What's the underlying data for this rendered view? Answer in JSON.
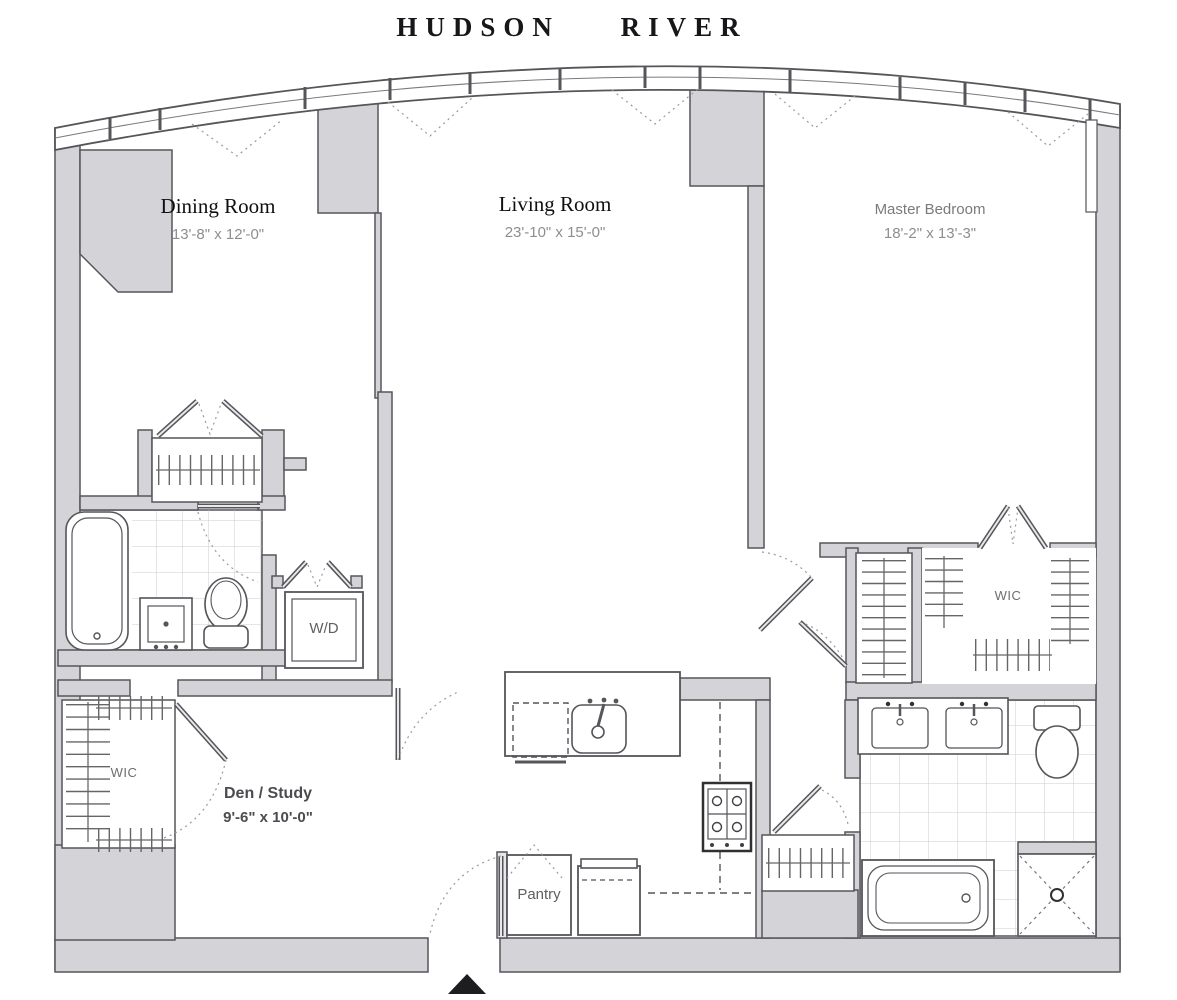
{
  "title": "HUDSON RIVER",
  "rooms": {
    "dining": {
      "name": "Dining Room",
      "dims": "13'-8\" x 12'-0\""
    },
    "living": {
      "name": "Living Room",
      "dims": "23'-10\" x 15'-0\""
    },
    "master": {
      "name": "Master Bedroom",
      "dims": "18'-2\" x 13'-3\""
    },
    "den": {
      "name": "Den / Study",
      "dims": "9'-6\" x 10'-0\""
    }
  },
  "labels": {
    "wic_left": "WIC",
    "wic_right": "WIC",
    "washer_dryer": "W/D",
    "pantry": "Pantry"
  },
  "colors": {
    "wall_fill": "#d4d4d8",
    "wall_stroke": "#57575b",
    "line": "#55555a",
    "dash": "#9a9a9e",
    "tile": "#c9cdd1",
    "entry_marker": "#1d1d1f"
  }
}
